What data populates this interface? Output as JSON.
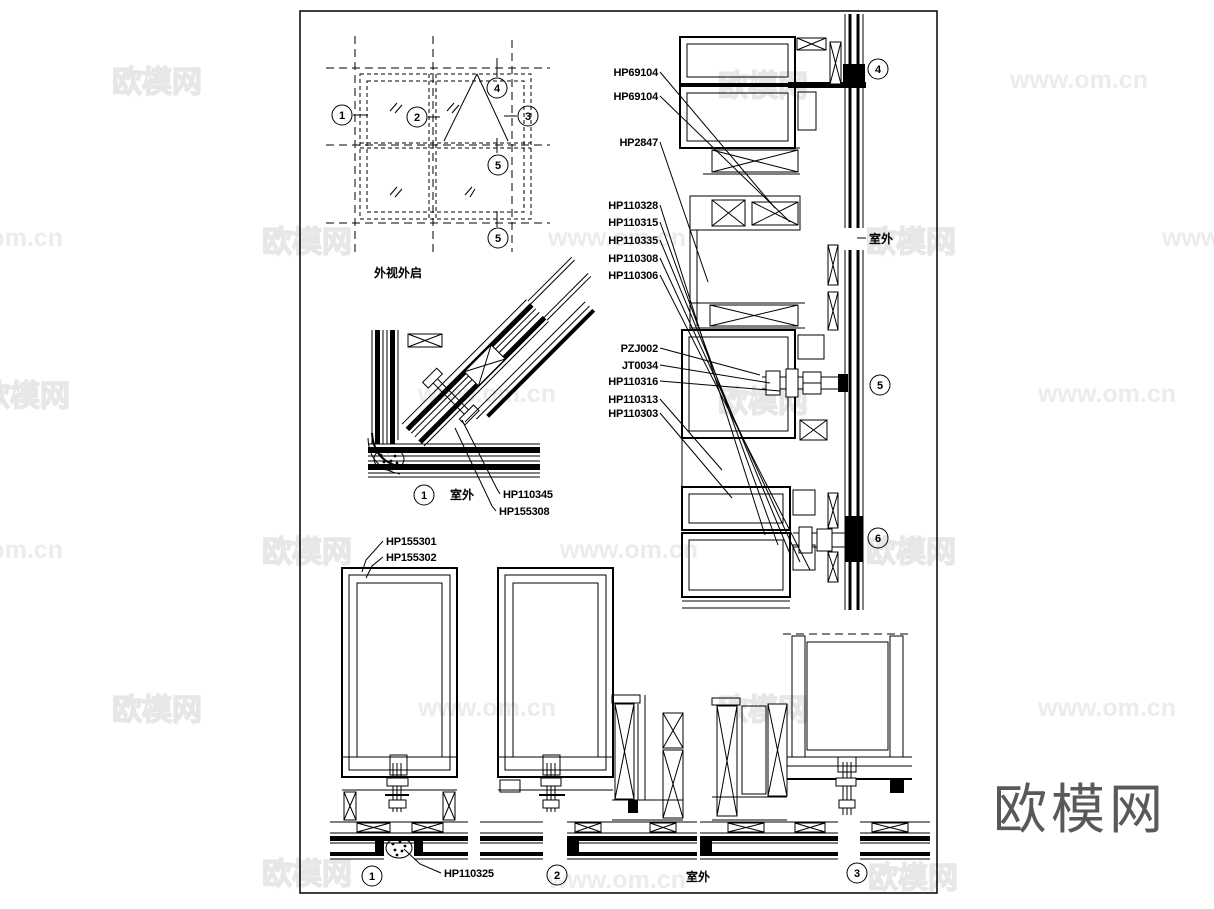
{
  "watermarks": {
    "brand": "欧模网",
    "site": "www.om.cn"
  },
  "brand_large": "欧模网",
  "plan": {
    "title": "外视外启",
    "bubble_1": "1",
    "bubble_2": "2",
    "bubble_3": "3",
    "bubble_4": "4",
    "bubble_5": "5",
    "bubble_5b": "5"
  },
  "callouts": {
    "hp69104a": "HP69104",
    "hp69104b": "HP69104",
    "hp2847": "HP2847",
    "hp110328": "HP110328",
    "hp110315": "HP110315",
    "hp110335": "HP110335",
    "hp110308": "HP110308",
    "hp110306": "HP110306",
    "pzj002": "PZJ002",
    "jt0034": "JT0034",
    "hp110316": "HP110316",
    "hp110313": "HP110313",
    "hp110303": "HP110303",
    "hp110345": "HP110345",
    "hp155308": "HP155308",
    "hp155301": "HP155301",
    "hp155302": "HP155302",
    "hp110325": "HP110325"
  },
  "texts": {
    "outdoor": "室外"
  },
  "details": {
    "corner": "1",
    "top_right": "4",
    "mid_right": "5",
    "low_right": "6",
    "sec1": "1",
    "sec2": "2",
    "sec3": "3"
  }
}
